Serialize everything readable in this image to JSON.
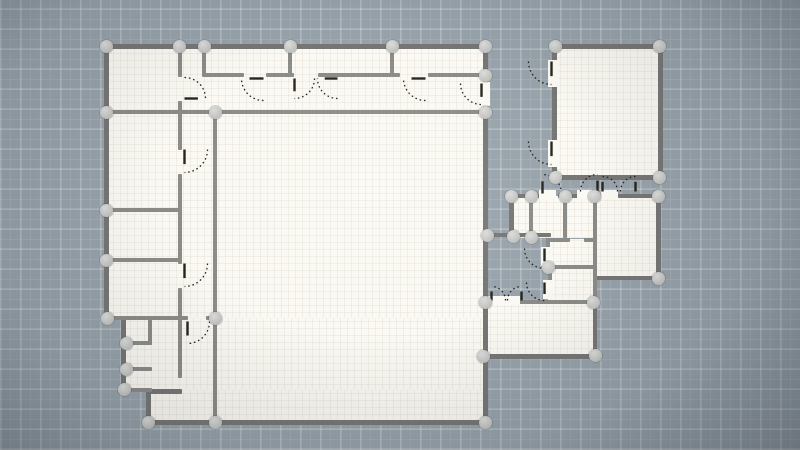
{
  "meta": {
    "app": "floor-plan-editor",
    "view": "2d-plan-canvas",
    "canvas": {
      "width": 800,
      "height": 450
    }
  },
  "colors": {
    "background": "#97a2aa",
    "grid_minor": "rgba(255,255,255,0.09)",
    "grid_major": "rgba(255,255,255,0.16)",
    "floor": "#fbf9f3",
    "floor_grid": "rgba(130,115,80,0.08)",
    "wall_exterior": "#767675",
    "wall_interior": "#8b8b87",
    "node_fill": "#c9cac8",
    "door_symbol": "#26261f",
    "node_diameter": 13
  },
  "plan": {
    "floors": [
      [
        106,
        46,
        379,
        274
      ],
      [
        123,
        318,
        362,
        74
      ],
      [
        148,
        390,
        337,
        32
      ],
      [
        553,
        46,
        106,
        131
      ],
      [
        511,
        196,
        87,
        42
      ],
      [
        593,
        196,
        66,
        82
      ],
      [
        546,
        239,
        51,
        30
      ],
      [
        548,
        267,
        49,
        35
      ],
      [
        483,
        301,
        113,
        55
      ]
    ],
    "walls_exterior": [
      [
        104,
        44,
        384,
        5
      ],
      [
        104,
        44,
        5,
        277
      ],
      [
        483,
        44,
        5,
        40
      ],
      [
        483,
        104,
        5,
        321
      ],
      [
        146,
        420,
        342,
        5
      ],
      [
        146,
        389,
        5,
        36
      ],
      [
        146,
        389,
        36,
        5
      ],
      [
        121,
        318,
        5,
        75
      ],
      [
        552,
        44,
        111,
        5
      ],
      [
        658,
        44,
        5,
        136
      ],
      [
        552,
        175,
        111,
        5
      ],
      [
        552,
        44,
        5,
        20
      ],
      [
        552,
        86,
        5,
        56
      ],
      [
        552,
        166,
        5,
        14
      ],
      [
        509,
        194,
        5,
        44
      ],
      [
        509,
        194,
        33,
        4
      ],
      [
        558,
        194,
        22,
        4
      ],
      [
        590,
        194,
        14,
        4
      ],
      [
        618,
        194,
        42,
        4
      ],
      [
        656,
        194,
        5,
        86
      ],
      [
        593,
        276,
        67,
        4
      ],
      [
        481,
        354,
        118,
        5
      ],
      [
        593,
        300,
        4,
        58
      ],
      [
        485,
        233,
        66,
        4
      ]
    ],
    "walls_interior": [
      [
        104,
        110,
        384,
        4
      ],
      [
        202,
        73,
        42,
        4
      ],
      [
        266,
        73,
        28,
        4
      ],
      [
        318,
        73,
        82,
        4
      ],
      [
        428,
        73,
        58,
        4
      ],
      [
        178,
        44,
        4,
        33
      ],
      [
        178,
        101,
        4,
        49
      ],
      [
        178,
        174,
        4,
        90
      ],
      [
        178,
        288,
        4,
        31
      ],
      [
        202,
        44,
        4,
        32
      ],
      [
        288,
        44,
        4,
        32
      ],
      [
        390,
        44,
        4,
        32
      ],
      [
        104,
        208,
        78,
        4
      ],
      [
        104,
        258,
        78,
        4
      ],
      [
        104,
        316,
        84,
        4
      ],
      [
        206,
        316,
        11,
        4
      ],
      [
        213,
        110,
        4,
        315
      ],
      [
        123,
        341,
        29,
        4
      ],
      [
        123,
        367,
        29,
        4
      ],
      [
        123,
        388,
        29,
        4
      ],
      [
        148,
        318,
        4,
        27
      ],
      [
        178,
        318,
        4,
        60
      ],
      [
        529,
        194,
        4,
        44
      ],
      [
        563,
        194,
        4,
        44
      ],
      [
        593,
        194,
        4,
        108
      ],
      [
        546,
        238,
        24,
        4
      ],
      [
        584,
        238,
        13,
        4
      ],
      [
        546,
        238,
        4,
        13
      ],
      [
        546,
        265,
        51,
        4
      ],
      [
        548,
        265,
        4,
        17
      ],
      [
        483,
        300,
        10,
        4
      ],
      [
        519,
        300,
        76,
        4
      ]
    ],
    "patches": [
      [
        548,
        60,
        11,
        27
      ],
      [
        548,
        140,
        11,
        27
      ],
      [
        539,
        190,
        17,
        9
      ],
      [
        577,
        190,
        15,
        9
      ],
      [
        601,
        190,
        17,
        9
      ],
      [
        541,
        247,
        11,
        19
      ],
      [
        543,
        280,
        11,
        19
      ],
      [
        488,
        296,
        32,
        9
      ],
      [
        480,
        82,
        10,
        24
      ]
    ],
    "doors": [
      {
        "x": 183,
        "y": 76,
        "s": 24,
        "rot": 270,
        "flip": false
      },
      {
        "x": 240,
        "y": 77,
        "s": 25,
        "rot": 90,
        "flip": false
      },
      {
        "x": 293,
        "y": 77,
        "s": 23,
        "rot": 0,
        "flip": false
      },
      {
        "x": 316,
        "y": 77,
        "s": 23,
        "rot": 90,
        "flip": false
      },
      {
        "x": 402,
        "y": 77,
        "s": 25,
        "rot": 90,
        "flip": false
      },
      {
        "x": 459,
        "y": 82,
        "s": 24,
        "rot": 0,
        "flip": true
      },
      {
        "x": 183,
        "y": 148,
        "s": 26,
        "rot": 0,
        "flip": false
      },
      {
        "x": 183,
        "y": 262,
        "s": 26,
        "rot": 0,
        "flip": false
      },
      {
        "x": 186,
        "y": 320,
        "s": 25,
        "rot": 0,
        "flip": false
      },
      {
        "x": 527,
        "y": 60,
        "s": 26,
        "rot": 0,
        "flip": true
      },
      {
        "x": 527,
        "y": 140,
        "s": 26,
        "rot": 0,
        "flip": true
      },
      {
        "x": 541,
        "y": 173,
        "s": 22,
        "rot": 180,
        "flip": true
      },
      {
        "x": 579,
        "y": 173,
        "s": 20,
        "rot": 180,
        "flip": false
      },
      {
        "x": 601,
        "y": 175,
        "s": 18,
        "rot": 180,
        "flip": true
      },
      {
        "x": 619,
        "y": 175,
        "s": 18,
        "rot": 180,
        "flip": false
      },
      {
        "x": 523,
        "y": 247,
        "s": 23,
        "rot": 0,
        "flip": true
      },
      {
        "x": 525,
        "y": 281,
        "s": 21,
        "rot": 0,
        "flip": true
      },
      {
        "x": 490,
        "y": 285,
        "s": 17,
        "rot": 180,
        "flip": true
      },
      {
        "x": 506,
        "y": 285,
        "s": 17,
        "rot": 180,
        "flip": false
      }
    ],
    "nodes": [
      [
        106,
        46
      ],
      [
        179,
        46
      ],
      [
        204,
        46
      ],
      [
        290,
        46
      ],
      [
        392,
        46
      ],
      [
        485,
        46
      ],
      [
        485,
        75
      ],
      [
        485,
        112
      ],
      [
        106,
        112
      ],
      [
        215,
        112
      ],
      [
        106,
        210
      ],
      [
        106,
        260
      ],
      [
        107,
        318
      ],
      [
        215,
        318
      ],
      [
        126,
        343
      ],
      [
        126,
        369
      ],
      [
        124,
        389
      ],
      [
        148,
        422
      ],
      [
        215,
        422
      ],
      [
        485,
        422
      ],
      [
        555,
        46
      ],
      [
        659,
        46
      ],
      [
        555,
        177
      ],
      [
        659,
        177
      ],
      [
        511,
        196
      ],
      [
        531,
        196
      ],
      [
        565,
        196
      ],
      [
        594,
        196
      ],
      [
        658,
        196
      ],
      [
        658,
        278
      ],
      [
        487,
        235
      ],
      [
        513,
        236
      ],
      [
        531,
        237
      ],
      [
        548,
        267
      ],
      [
        485,
        302
      ],
      [
        593,
        302
      ],
      [
        595,
        355
      ],
      [
        483,
        356
      ]
    ]
  }
}
